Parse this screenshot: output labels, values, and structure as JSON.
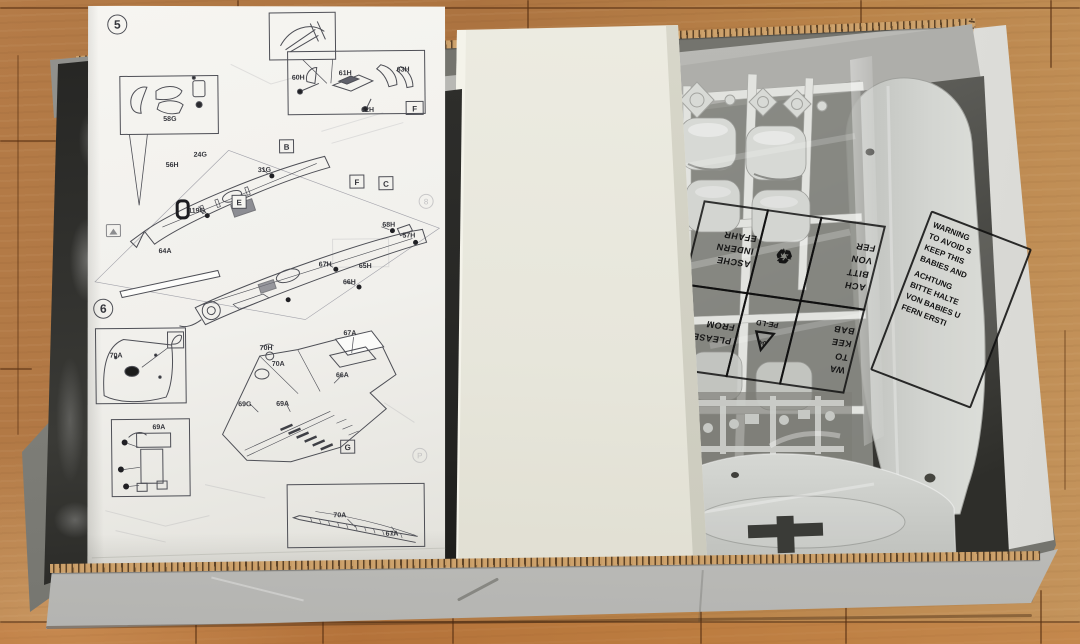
{
  "instruction_sheet": {
    "step5": {
      "step_number": "5",
      "labels": {
        "l58g": "58G",
        "l60h": "60H",
        "l61h": "61H",
        "l62h": "62H",
        "l63h": "63H",
        "f_inset": "F",
        "frame_b": "B",
        "frame_e": "E",
        "frame_f": "F",
        "frame_c": "C",
        "l24g": "24G",
        "l56h": "56H",
        "l31g": "31G",
        "l119g": "119G",
        "l64a": "64A",
        "l67h": "67H",
        "l65h": "65H",
        "l66h": "66H",
        "l68h": "68H",
        "l57h": "57H"
      }
    },
    "step6": {
      "step_number": "6",
      "labels": {
        "l70a_inset": "70A",
        "l69a_inset": "69A",
        "frame_g": "G",
        "l70h": "70H",
        "l70a": "70A",
        "l67a": "67A",
        "l66a": "66A",
        "l69g": "69G",
        "l69a": "69A",
        "l70a_profile": "70A",
        "l67a_profile": "67A"
      }
    },
    "page_marks": {
      "m1": "8",
      "m2": "P"
    }
  },
  "bags": {
    "grid_label": {
      "de_short": [
        "ACH",
        "BITT",
        "VON",
        "FER"
      ],
      "de_long": [
        "ASCHE",
        "INDERN",
        "EFAHR"
      ],
      "en_short": [
        "WA",
        "TO",
        "KEE",
        "BAB"
      ],
      "en_long": [
        "PLEASE",
        "FROM"
      ],
      "recycle_code": "04",
      "material_code": "PE-LD",
      "recycle_circle_icon": "♻",
      "recycle_triangle_icon": "△"
    },
    "warning_label": {
      "lines": [
        "WARNING",
        "TO AVOID S",
        "KEEP THIS",
        "BABIES AND",
        "ACHTUNG",
        "BITTE HALTE",
        "VON BABIES U",
        "FERN ERSTI"
      ]
    }
  },
  "colors": {
    "wood": "#b47b47",
    "cardboard_outer": "#cfcfcc",
    "cardboard_inner": "#b5b5b1",
    "cream_box": "#e9e8de",
    "paper": "#f4f3ef",
    "sprue_gray": "#d3d5d1",
    "cross_marking": "#3b3c38",
    "bag_print": "#141414"
  }
}
